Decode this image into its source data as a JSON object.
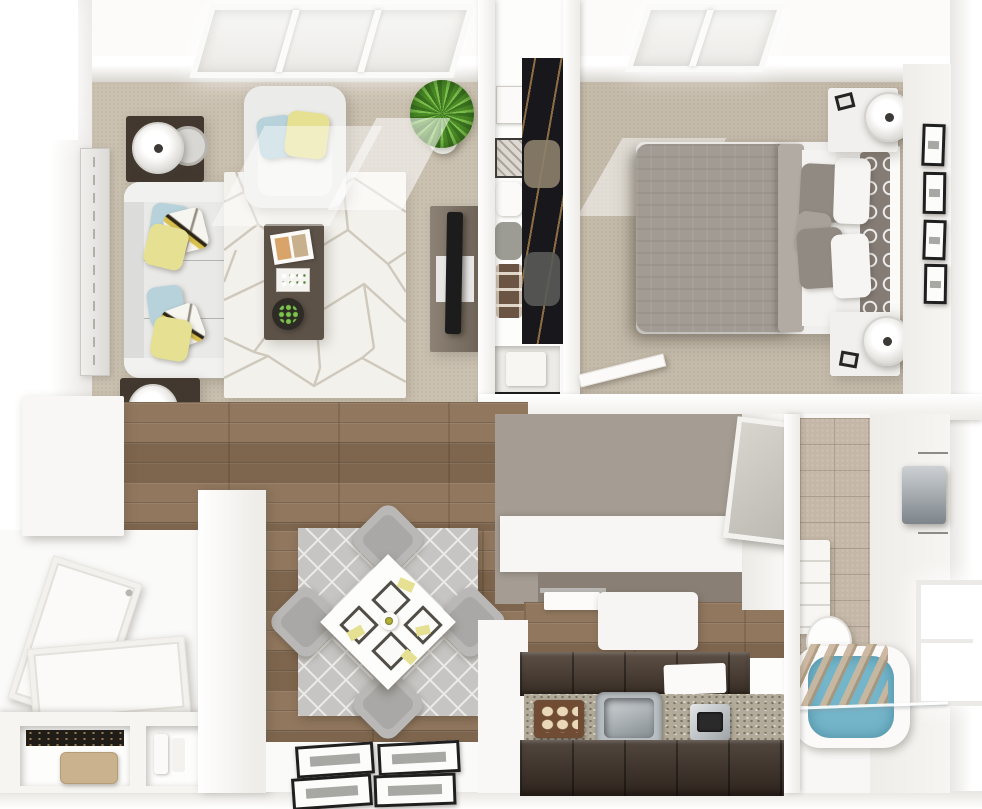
{
  "scene": {
    "title": "3D rendered top-down floor plan of a one-bedroom apartment",
    "view": "top-down 3D architectural render",
    "canvas": {
      "width": 982,
      "height": 809
    }
  },
  "palette": {
    "wall_white": "#fbfaf8",
    "carpet_living": "#cbc1b1",
    "carpet_bedroom": "#c5bbab",
    "wood": "#8a6f55",
    "hall_floor": "#a59d93",
    "rug_living": "#f3f1ec",
    "rug_dining": "#c6c5c3",
    "sofa": "#e9e9e7",
    "armchair": "#ebebe9",
    "pillow_blue": "#b7d2da",
    "pillow_yellow": "#e5e092",
    "pillow_gray": "#918a83",
    "trellis": "#847c75",
    "duvet": "#a29b94",
    "sheet": "#f4f3f1",
    "nightstand": "#f1f0ee",
    "dark_wood": "#5d5248",
    "tv_black": "#1c1c1c",
    "closet_dark": "#17171c",
    "tile": "#c4b7a7",
    "water": "#74b5ca",
    "cabinet": "#46382d",
    "cabinet_dark": "#3a2e25",
    "granite": "#b3ab9a",
    "counter_under": "#8a7f74",
    "chair_gray": "#b9b8b6",
    "towel_gray": "#9aa2a8",
    "plant_green": "#55972e",
    "door_white": "#f9f8f6",
    "basket_brown": "#6b5443",
    "clutch_tan": "#c9b28d"
  },
  "rooms": {
    "living_room": {
      "label": "living room",
      "floor": "beige carpet",
      "items": [
        "skylight",
        "sofa with blue and yellow pillows",
        "armchair",
        "geometric area rug",
        "dark wood coffee table",
        "magazine",
        "flower tray",
        "succulent bowl",
        "tv stand",
        "flat tv",
        "two side tables with drum lamps",
        "wall mirror art",
        "potted plant"
      ]
    },
    "walk_in_closet": {
      "label": "walk-in closet",
      "items": [
        "hanging dark clothes",
        "shelf boxes",
        "storage basket",
        "folded pillow",
        "bottom cubby box"
      ]
    },
    "bedroom": {
      "label": "bedroom",
      "floor": "beige carpet",
      "items": [
        "skylight",
        "queen bed with gray duvet",
        "white and gray pillows",
        "trellis accent pillows",
        "two nightstands with lamps",
        "four wall frames",
        "open door leaf"
      ]
    },
    "hallway": {
      "label": "hallway / vanity nook",
      "items": [
        "white counter",
        "leaning mirror",
        "towel bar",
        "white appliance"
      ]
    },
    "bathroom": {
      "label": "bathroom",
      "items": [
        "stone tile wall",
        "towel dispenser",
        "bright window",
        "console shelf",
        "toilet",
        "bathtub with blue water",
        "wood bath tray",
        "glass panel"
      ]
    },
    "kitchen": {
      "label": "kitchen",
      "items": [
        "dark brown upper cabinet run",
        "granite countertop",
        "stainless sink",
        "cutting board with bread",
        "chrome toaster",
        "dish towel",
        "dark brown lower cabinet run"
      ]
    },
    "dining_area": {
      "label": "dining area",
      "floor": "wood planks",
      "items": [
        "lattice rug",
        "white square table rotated 45",
        "four gray chairs",
        "four placemats",
        "yellow napkins",
        "flower centerpiece"
      ]
    },
    "entry": {
      "label": "entry / foyer",
      "items": [
        "white open doors",
        "wall cabinet",
        "shoe cubbies",
        "tan clutch",
        "white jars",
        "four framed prints on floor"
      ]
    }
  }
}
